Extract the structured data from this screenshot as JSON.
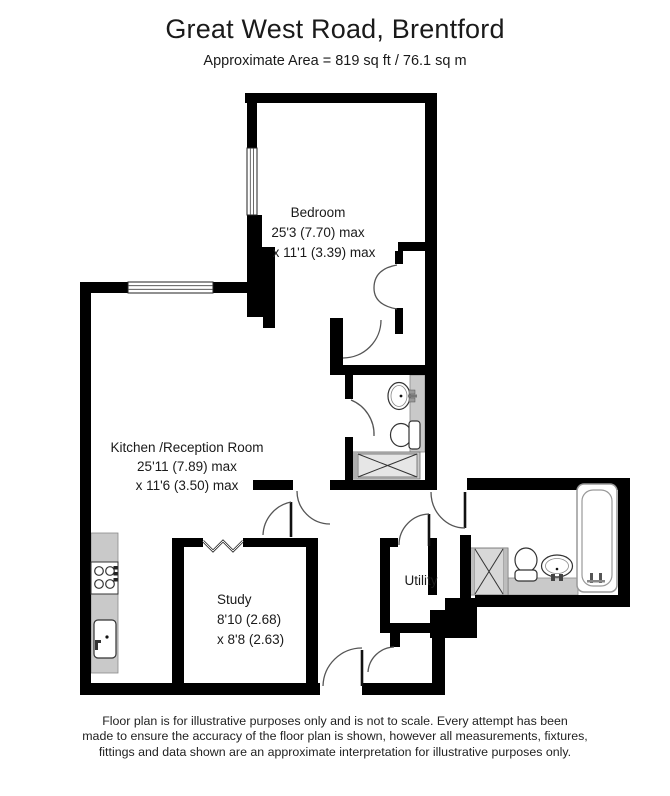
{
  "header": {
    "title": "Great West Road, Brentford",
    "subtitle": "Approximate Area = 819 sq ft / 76.1 sq m"
  },
  "rooms": {
    "bedroom": {
      "name": "Bedroom",
      "dim1": "25'3 (7.70) max",
      "dim2": "x 11'1 (3.39) max"
    },
    "kitchen": {
      "name": "Kitchen /Reception Room",
      "dim1": "25'11 (7.89) max",
      "dim2": "x 11'6 (3.50) max"
    },
    "study": {
      "name": "Study",
      "dim1": "8'10 (2.68)",
      "dim2": "x 8'8 (2.63)"
    },
    "utility": {
      "name": "Utility"
    }
  },
  "fixtures": [
    "bathtub",
    "shower",
    "shower-tray",
    "toilet",
    "basin",
    "hob",
    "kitchen-sink",
    "wardrobe",
    "window",
    "door"
  ],
  "colors": {
    "wall": "#000000",
    "counter": "#c9c9c9",
    "text": "#1a1a1a"
  },
  "footer": {
    "line1": "Floor plan is for illustrative purposes only and is not to scale. Every attempt has been",
    "line2": "made to ensure the accuracy of the floor plan is shown, however all measurements, fixtures,",
    "line3": "fittings and data shown are an approximate interpretation for illustrative purposes only."
  }
}
